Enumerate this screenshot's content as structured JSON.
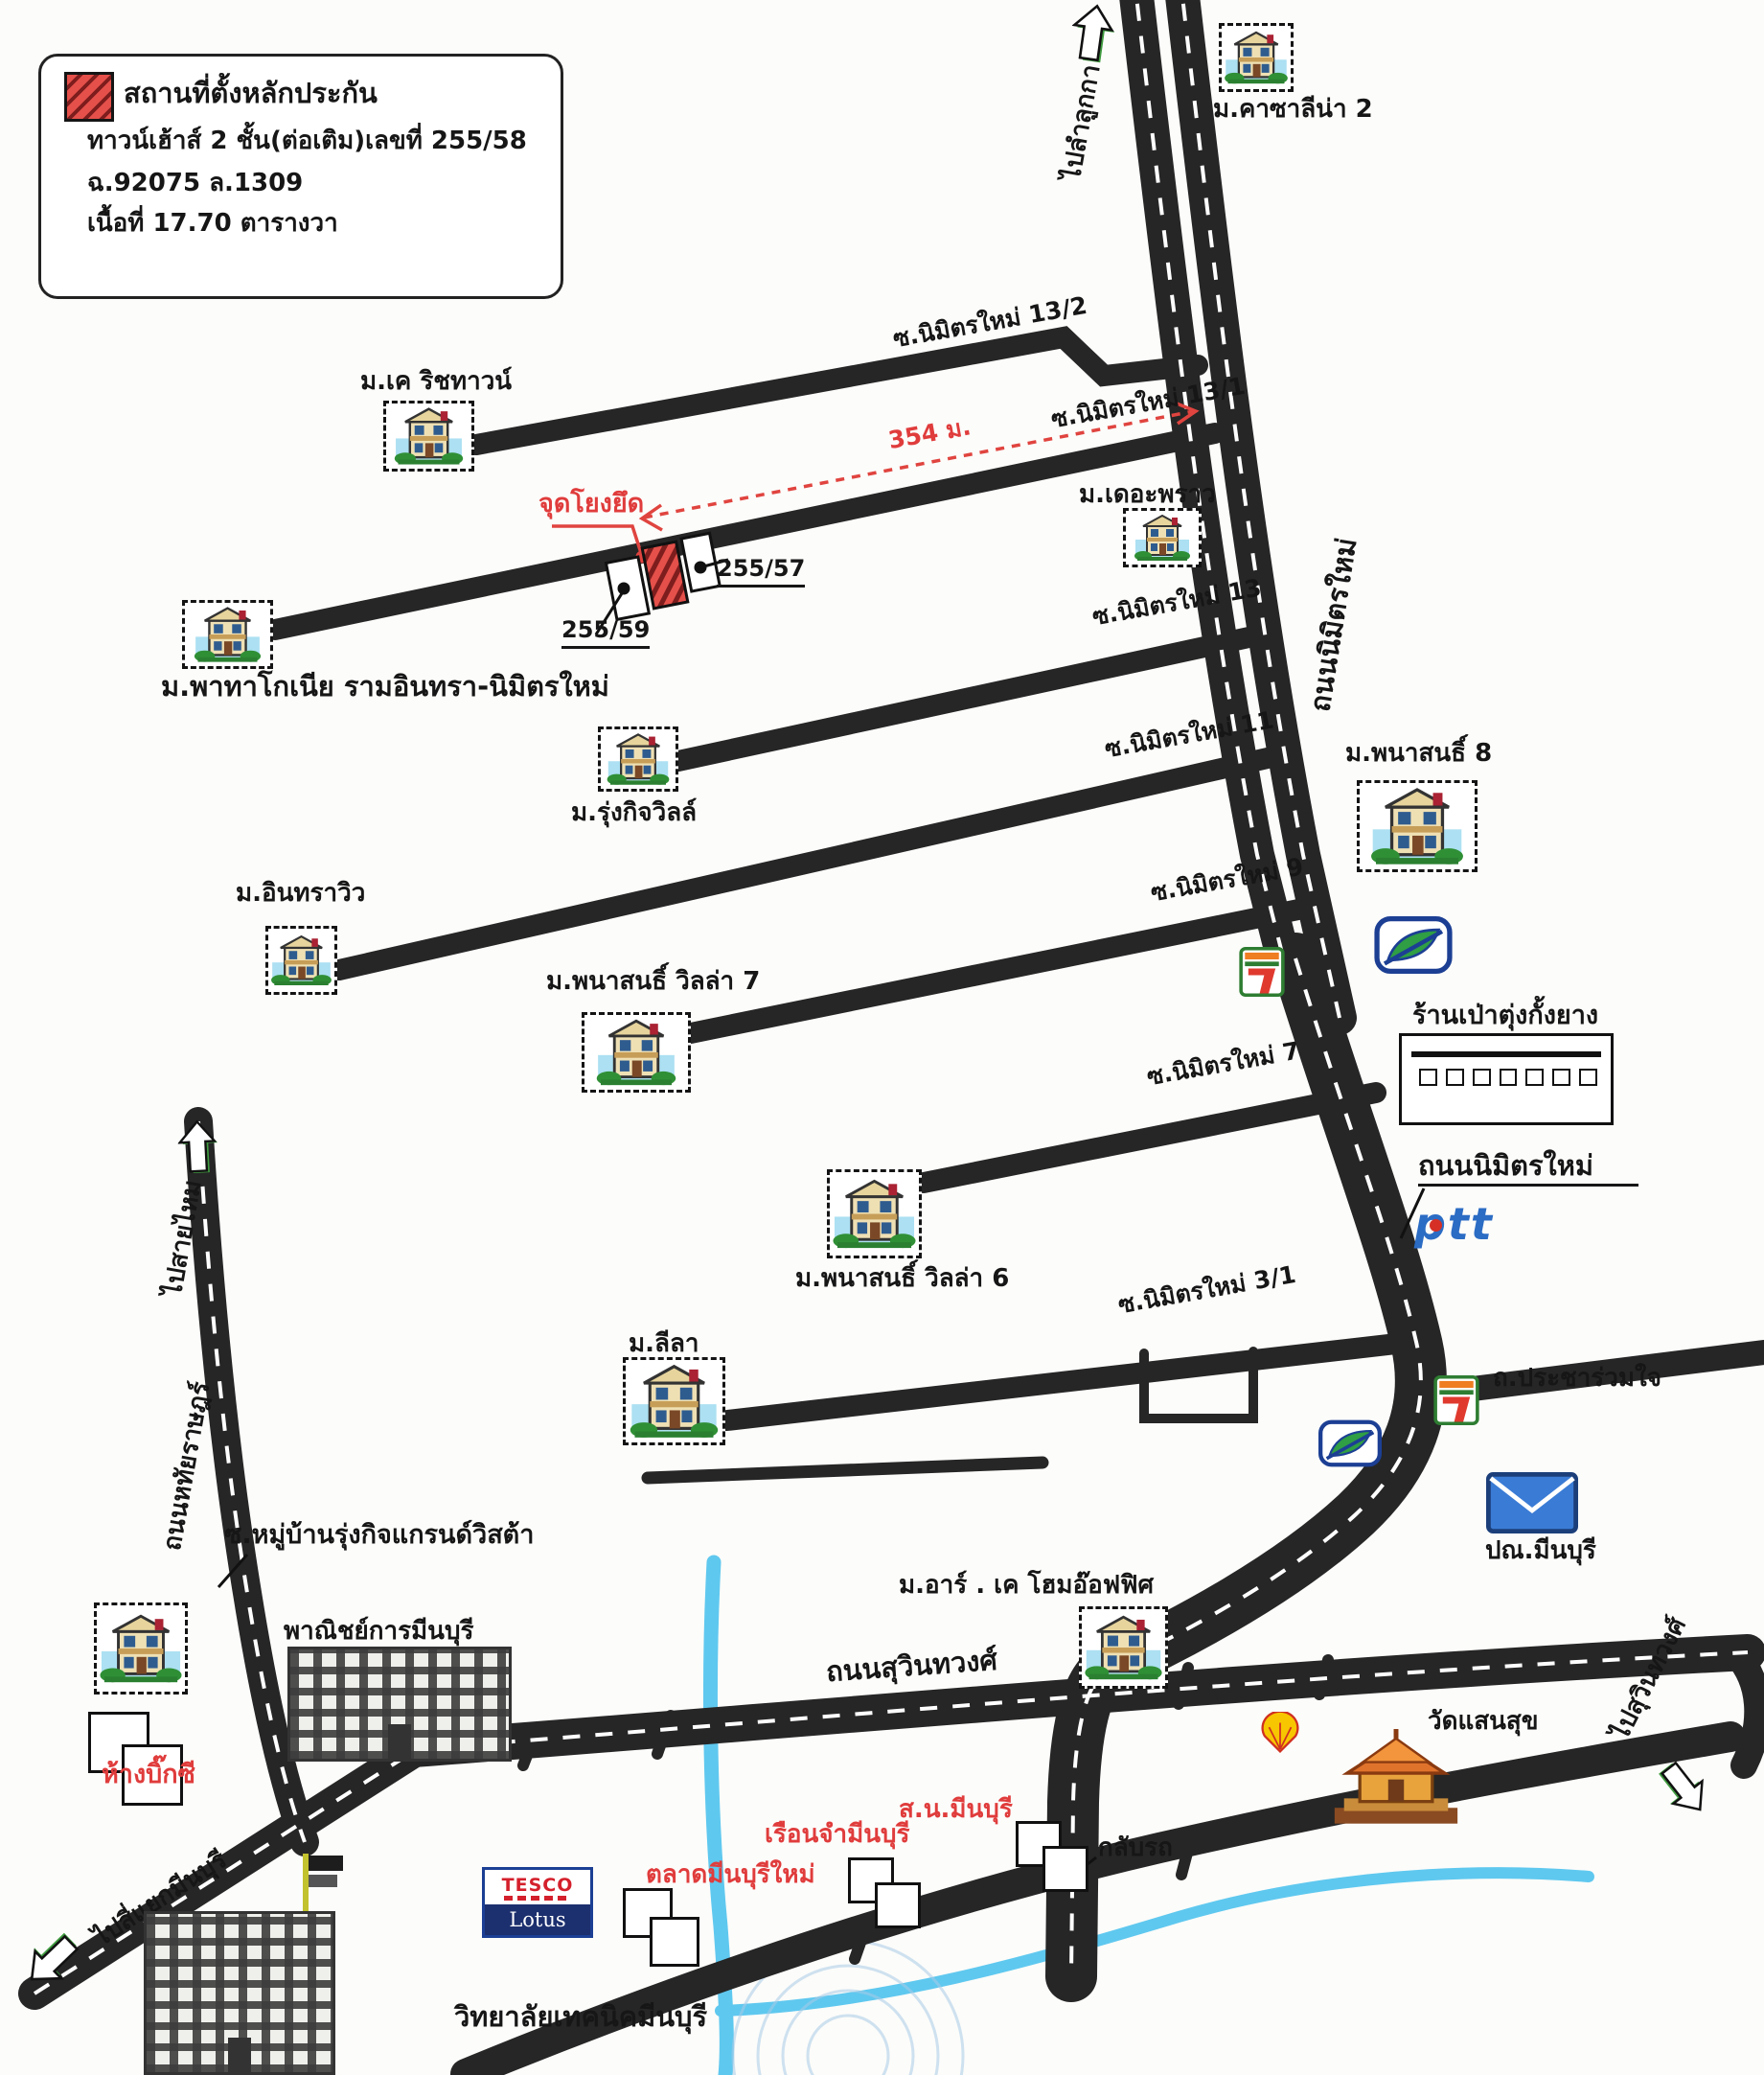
{
  "legend": {
    "title": "สถานที่ตั้งหลักประกัน",
    "line1": "ทาวน์เฮ้าส์ 2 ชั้น(ต่อเติม)เลขที่ 255/58",
    "line2": "ฉ.92075  ล.1309",
    "line3": "เนื้อที่ 17.70 ตารางวา"
  },
  "roads": {
    "nimit_mai_vertical": "ถนนนิมิตรใหม่",
    "nimit_mai_sign": "ถนนนิมิตรใหม่",
    "suwinthawong": "ถนนสุวินทวงศ์",
    "hathairat": "ถนนหทัยราษฎร์",
    "pracha_ruam_jai": "ถ.ประชาร่วมใจ",
    "soi_13_2": "ซ.นิมิตรใหม่ 13/2",
    "soi_13_1": "ซ.นิมิตรใหม่ 13/1",
    "soi_13": "ซ.นิมิตรใหม่ 13",
    "soi_11": "ซ.นิมิตรใหม่ 11",
    "soi_9": "ซ.นิมิตรใหม่ 9",
    "soi_7": "ซ.นิมิตรใหม่ 7",
    "soi_3_1": "ซ.นิมิตรใหม่ 3/1",
    "soi_rungkit": "ซ.หมู่บ้านรุ่งกิจแกรนด์วิสต้า"
  },
  "directions": {
    "to_lam_luk_ka": "ไปลำลูกกา",
    "to_sai_mai": "ไปสายไหม",
    "to_suwinthawong": "ไปสุวินทวงศ์",
    "to_min_buri_intersection": "ไปสี่แยกมีนบุรี"
  },
  "villages": {
    "casalina": "ม.คาซาลีน่า 2",
    "k_rich_town": "ม.เค ริชทาวน์",
    "patagonia": "ม.พาทาโกเนีย รามอินทรา-นิมิตรใหม่",
    "the_proud": "ม.เดอะพราว",
    "rungkit_ville": "ม.รุ่งกิจวิลล์",
    "phanasonthi_8": "ม.พนาสนธิ์ 8",
    "indraview": "ม.อินทราวิว",
    "phanasonthi_villa_7": "ม.พนาสนธิ์  วิลล่า 7",
    "phanasonthi_villa_6": "ม.พนาสนธิ์  วิลล่า 6",
    "leela": "ม.ลีลา",
    "rk_home_office": "ม.อาร์ . เค โฮมอ๊อฟฟิศ"
  },
  "landmarks": {
    "tire_shop": "ร้านเป่าตุ่งกั้งยาง",
    "post_office": "ปณ.มีนบุรี",
    "commercial_college": "พาณิชย์การมีนบุรี",
    "big_c": "ห้างบิ๊กซี",
    "police_station": "ส.น.มีนบุรี",
    "prison": "เรือนจำมีนบุรี",
    "market": "ตลาดมีนบุรีใหม่",
    "u_turn": "กลับรถ",
    "technical_college": "วิทยาลัยเทคนิคมีนบุรี",
    "temple": "วัดแสนสุข"
  },
  "annotations": {
    "anchor_label": "จุดโยงยึด",
    "distance": "354 ม.",
    "parcel_right": "255/57",
    "parcel_left": "255/59"
  },
  "logos": {
    "ptt": "ptt",
    "tesco": "TESCO",
    "lotus": "Lotus",
    "seven_eleven": "7"
  },
  "colors": {
    "road": "#262626",
    "canal": "#5fc8ef",
    "highlight_red": "#e03c3c",
    "arrow_green": "#3f9b3f"
  }
}
